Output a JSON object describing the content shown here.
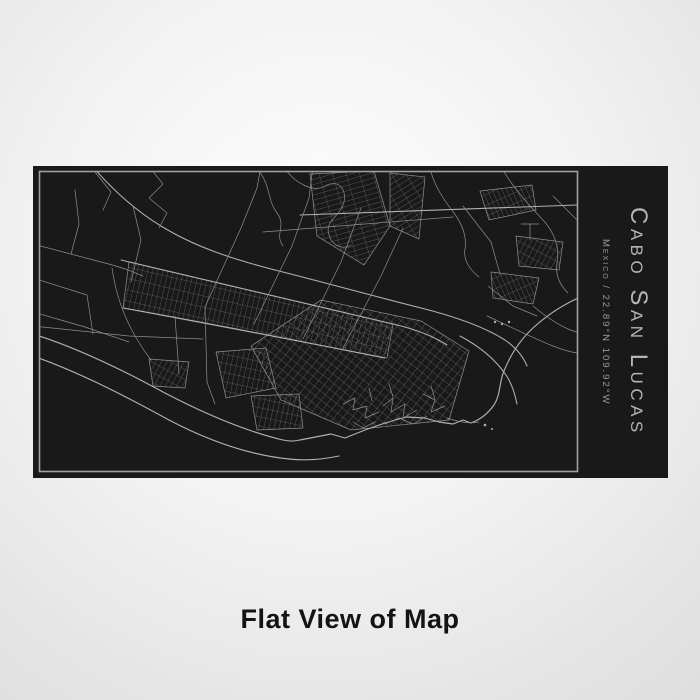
{
  "engraving": {
    "title": "Cabo San Lucas",
    "subtitle": "Mexico / 22.89°N 109.92°W"
  },
  "caption": {
    "text": "Flat View of Map"
  },
  "map": {
    "location": "Cabo San Lucas",
    "country": "Mexico",
    "latitude": "22.89°N",
    "longitude": "109.92°W"
  },
  "colors": {
    "panel_bg": "#191919",
    "frame": "#a0a0a0",
    "map_line": "#8f8f8f",
    "map_line_strong": "#b1b1b1",
    "title": "#b5b5b5",
    "subtitle": "#9b9b9b",
    "caption": "#141414"
  }
}
